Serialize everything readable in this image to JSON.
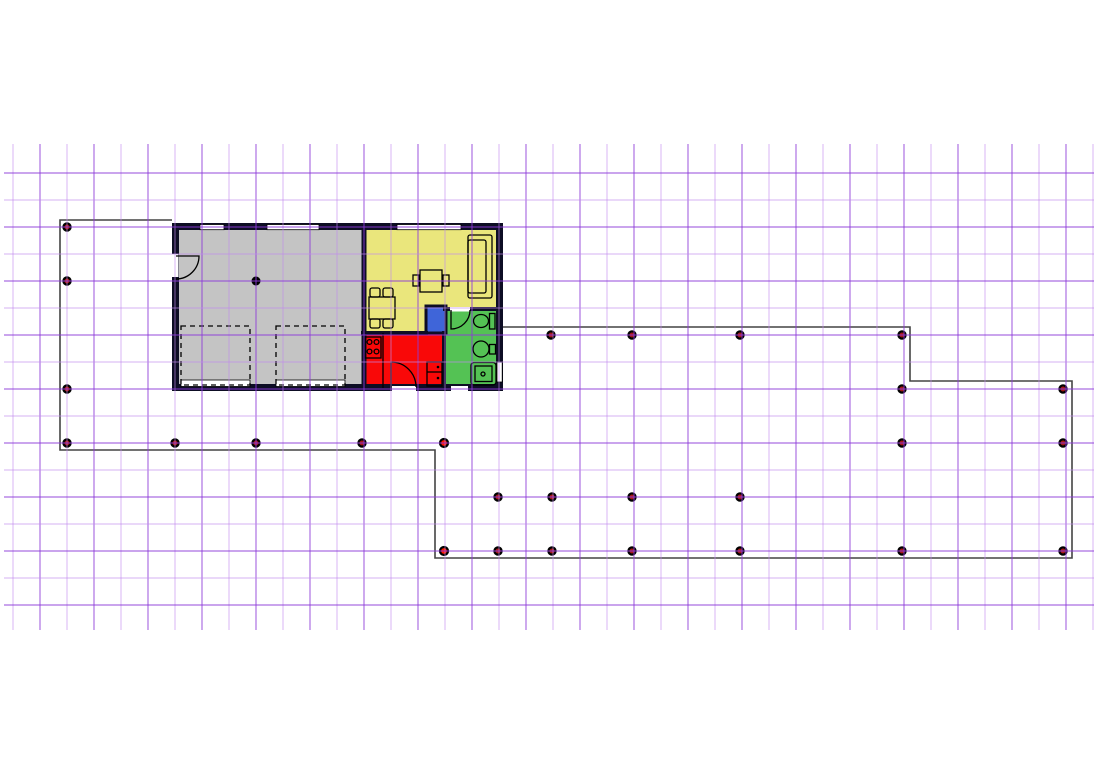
{
  "canvas": {
    "width": 1116,
    "height": 784,
    "background": "#ffffff"
  },
  "drawing": {
    "grid": {
      "v": {
        "start": 13,
        "spacing": 27,
        "count": 41,
        "y1": 144,
        "y2": 630,
        "phase_dark": 1
      },
      "h": {
        "start": 173,
        "spacing": 27,
        "count": 17,
        "x1": 4,
        "x2": 1094,
        "phase_dark": 0
      },
      "light_color": "#c18bee",
      "dark_color": "#8d3ad8",
      "light_opacity": 0.45,
      "dark_opacity": 0.62,
      "line_width": 1.4
    },
    "deck": {
      "color": "#444444",
      "width": 1.6,
      "points": "172,220 60,220 60,450 435,450 435,558 1072,558 1072,381 910,381 910,327 503,327"
    },
    "house": {
      "wall_color": "#0d0d24",
      "outer_wall": {
        "x": 175.5,
        "y": 226.5,
        "w": 324,
        "h": 161,
        "thickness": 7
      },
      "rooms": [
        {
          "name": "garage",
          "color": "#c4c4c4",
          "x": 174,
          "y": 225,
          "w": 192,
          "h": 164
        },
        {
          "name": "living-room",
          "color": "#eae67c",
          "x": 364,
          "y": 225,
          "w": 137,
          "h": 108
        },
        {
          "name": "kitchen",
          "color": "#f90808",
          "x": 364,
          "y": 331,
          "w": 81,
          "h": 58
        },
        {
          "name": "bathroom",
          "color": "#54c254",
          "x": 443,
          "y": 309,
          "w": 58,
          "h": 80
        },
        {
          "name": "closet",
          "color": "#3f65d9",
          "x": 427,
          "y": 307,
          "w": 18,
          "h": 25
        }
      ],
      "inner_walls": [
        {
          "name": "wall-garage-living",
          "x1": 364,
          "y1": 226,
          "x2": 364,
          "y2": 388,
          "w": 5
        },
        {
          "name": "wall-living-kitchen",
          "x1": 361,
          "y1": 333,
          "x2": 428,
          "y2": 333,
          "w": 4
        },
        {
          "name": "wall-kitchen-bathroom",
          "x1": 444,
          "y1": 331,
          "x2": 444,
          "y2": 389,
          "w": 4
        },
        {
          "name": "wall-living-bathroom",
          "x1": 443,
          "y1": 309,
          "x2": 500,
          "y2": 309,
          "w": 4
        }
      ],
      "closet_wall": {
        "x": 426,
        "y": 306,
        "w": 20,
        "h": 27,
        "t": 3
      },
      "openings": [
        {
          "name": "window-garage-1",
          "x": 200,
          "y": 224.5,
          "w": 24,
          "h": 5.2,
          "outlined": true
        },
        {
          "name": "window-garage-2",
          "x": 267,
          "y": 224.5,
          "w": 52,
          "h": 5.2,
          "outlined": true
        },
        {
          "name": "window-living",
          "x": 397,
          "y": 224.5,
          "w": 64,
          "h": 5.2,
          "outlined": true
        },
        {
          "name": "window-bathroom",
          "x": 497,
          "y": 362,
          "w": 5.2,
          "h": 20,
          "outlined": true
        },
        {
          "name": "door-gap-garage",
          "x": 172,
          "y": 254,
          "w": 6.5,
          "h": 23,
          "outlined": false
        },
        {
          "name": "garage-door-1",
          "x": 181,
          "y": 380,
          "w": 69,
          "h": 6.5,
          "outlined": true
        },
        {
          "name": "garage-door-2",
          "x": 276,
          "y": 380,
          "w": 69,
          "h": 6.5,
          "outlined": true
        },
        {
          "name": "door-gap-kitchen",
          "x": 392,
          "y": 386,
          "w": 24,
          "h": 5.5,
          "outlined": false
        },
        {
          "name": "door-gap-bathroom-ext",
          "x": 451,
          "y": 386,
          "w": 17,
          "h": 5.5,
          "outlined": false
        },
        {
          "name": "door-gap-bathroom-int",
          "x": 450,
          "y": 307,
          "w": 20,
          "h": 4.5,
          "outlined": false
        }
      ],
      "furniture": [
        {
          "name": "garage-column",
          "shapes": [
            {
              "t": "circle",
              "cx": 256,
              "cy": 281,
              "r": 4.5,
              "f": "#000000"
            }
          ]
        },
        {
          "name": "garage-entry-door",
          "shapes": [
            {
              "t": "path",
              "d": "M 176 256 L 199 256 A 23 23 0 0 1 176 279"
            }
          ]
        },
        {
          "name": "parking-space-1",
          "dash": "5 4",
          "shapes": [
            {
              "t": "rect",
              "x": 181,
              "y": 326,
              "w": 69,
              "h": 59
            }
          ]
        },
        {
          "name": "parking-space-2",
          "dash": "5 4",
          "shapes": [
            {
              "t": "rect",
              "x": 276,
              "y": 326,
              "w": 69,
              "h": 59
            }
          ]
        },
        {
          "name": "sofa",
          "shapes": [
            {
              "t": "rect",
              "x": 468,
              "y": 235,
              "w": 24,
              "h": 63,
              "rx": 2
            },
            {
              "t": "rect",
              "x": 468,
              "y": 240,
              "w": 18,
              "h": 53,
              "rx": 2
            }
          ]
        },
        {
          "name": "side-table",
          "shapes": [
            {
              "t": "rect",
              "x": 420,
              "y": 270,
              "w": 22,
              "h": 22
            },
            {
              "t": "rect",
              "x": 413,
              "y": 275,
              "w": 6,
              "h": 11
            },
            {
              "t": "rect",
              "x": 443,
              "y": 275,
              "w": 6,
              "h": 11
            }
          ]
        },
        {
          "name": "dining-table",
          "shapes": [
            {
              "t": "rect",
              "x": 369,
              "y": 297,
              "w": 26,
              "h": 22
            },
            {
              "t": "rect",
              "x": 370,
              "y": 288,
              "w": 10,
              "h": 9,
              "rx": 2
            },
            {
              "t": "rect",
              "x": 383,
              "y": 288,
              "w": 10,
              "h": 9,
              "rx": 2
            },
            {
              "t": "rect",
              "x": 370,
              "y": 319,
              "w": 10,
              "h": 9,
              "rx": 2
            },
            {
              "t": "rect",
              "x": 383,
              "y": 319,
              "w": 10,
              "h": 9,
              "rx": 2
            }
          ]
        },
        {
          "name": "stove",
          "shapes": [
            {
              "t": "rect",
              "x": 365,
              "y": 337,
              "w": 16,
              "h": 21
            },
            {
              "t": "circle",
              "cx": 369.5,
              "cy": 342,
              "r": 2.4
            },
            {
              "t": "circle",
              "cx": 376.5,
              "cy": 342,
              "r": 2.4
            },
            {
              "t": "circle",
              "cx": 369.5,
              "cy": 351.5,
              "r": 2.4
            },
            {
              "t": "circle",
              "cx": 376.5,
              "cy": 351.5,
              "r": 2.4
            }
          ]
        },
        {
          "name": "kitchen-counter-line",
          "shapes": [
            {
              "t": "line",
              "x1": 383,
              "y1": 333,
              "x2": 383,
              "y2": 388
            }
          ]
        },
        {
          "name": "kitchen-door",
          "shapes": [
            {
              "t": "path",
              "d": "M 391 387 L 391 362 A 25 25 0 0 1 416 387"
            }
          ]
        },
        {
          "name": "fridge",
          "shapes": [
            {
              "t": "rect",
              "x": 427,
              "y": 362,
              "w": 15,
              "h": 24
            },
            {
              "t": "line",
              "x1": 427,
              "y1": 372,
              "x2": 442,
              "y2": 372
            },
            {
              "t": "circle",
              "cx": 438,
              "cy": 367,
              "r": 1.3,
              "f": "#000000"
            },
            {
              "t": "circle",
              "cx": 438,
              "cy": 378,
              "r": 1.3,
              "f": "#000000"
            }
          ]
        },
        {
          "name": "bathroom-door",
          "shapes": [
            {
              "t": "path",
              "d": "M 451 310 L 451 329 A 19 19 0 0 0 470 310"
            }
          ]
        },
        {
          "name": "toilet",
          "shapes": [
            {
              "t": "ellipse",
              "cx": 481,
              "cy": 321,
              "rx": 7.5,
              "ry": 6.5
            },
            {
              "t": "rect",
              "x": 489.5,
              "y": 313.5,
              "w": 5.5,
              "h": 15.5
            }
          ]
        },
        {
          "name": "sink",
          "shapes": [
            {
              "t": "circle",
              "cx": 481,
              "cy": 349,
              "r": 8
            },
            {
              "t": "rect",
              "x": 489.5,
              "y": 344.5,
              "w": 6,
              "h": 9.5
            }
          ]
        },
        {
          "name": "shower",
          "shapes": [
            {
              "t": "rect",
              "x": 471,
              "y": 362.5,
              "w": 25,
              "h": 22.5,
              "rx": 3
            },
            {
              "t": "rect",
              "x": 475,
              "y": 366,
              "w": 17,
              "h": 15.5
            },
            {
              "t": "circle",
              "cx": 483,
              "cy": 374,
              "r": 2
            }
          ]
        }
      ]
    },
    "posts": {
      "style": {
        "radius": 3.6,
        "ring": "#000000",
        "ring_width": 2.2,
        "fill": "#a51717"
      },
      "selected_style": {
        "radius": 4,
        "ring": "#000000",
        "ring_width": 2.2,
        "fill": "#ff1500"
      },
      "regular": [
        [
          67,
          227
        ],
        [
          67,
          281
        ],
        [
          67,
          389
        ],
        [
          67,
          443
        ],
        [
          175,
          443
        ],
        [
          256,
          443
        ],
        [
          362,
          443
        ],
        [
          551,
          335
        ],
        [
          632,
          335
        ],
        [
          740,
          335
        ],
        [
          902,
          335
        ],
        [
          902,
          389
        ],
        [
          1063,
          389
        ],
        [
          902,
          443
        ],
        [
          1063,
          443
        ],
        [
          498,
          497
        ],
        [
          552,
          497
        ],
        [
          632,
          497
        ],
        [
          740,
          497
        ],
        [
          498,
          551
        ],
        [
          552,
          551
        ],
        [
          632,
          551
        ],
        [
          740,
          551
        ],
        [
          902,
          551
        ],
        [
          1063,
          551
        ]
      ],
      "selected": [
        [
          444,
          443
        ],
        [
          444,
          551
        ]
      ]
    }
  }
}
